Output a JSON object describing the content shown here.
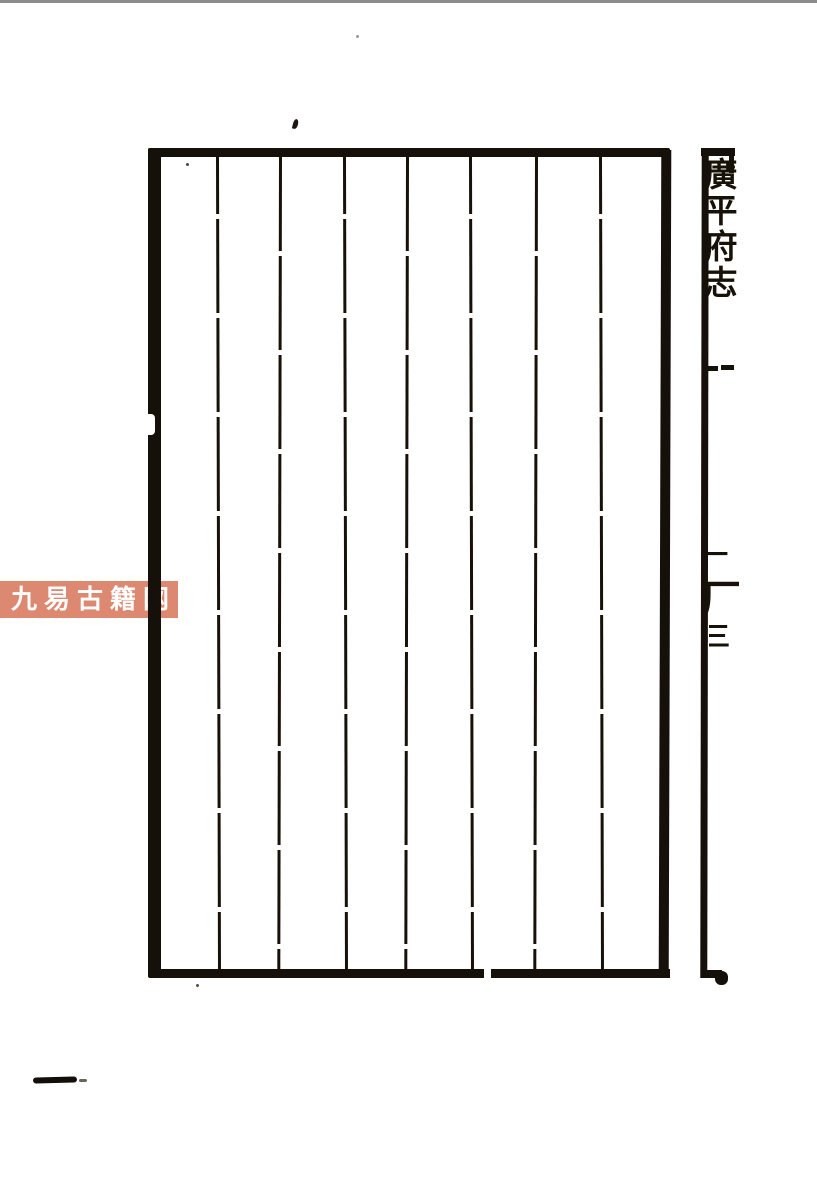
{
  "document": {
    "kind": "scanned woodblock-printed book folio, blank ruled page",
    "paper_color": "#ffffff",
    "ink_color": "#151009",
    "scan_edge_color": "#8b8b8b",
    "column_count": 8
  },
  "spine": {
    "title": "廣平府志",
    "lower_marks": {
      "first": "一",
      "second": "厂",
      "third": "三"
    }
  },
  "watermark": {
    "text": "九易古籍网",
    "background_color": "#dd8972",
    "text_color": "#ffffff"
  }
}
